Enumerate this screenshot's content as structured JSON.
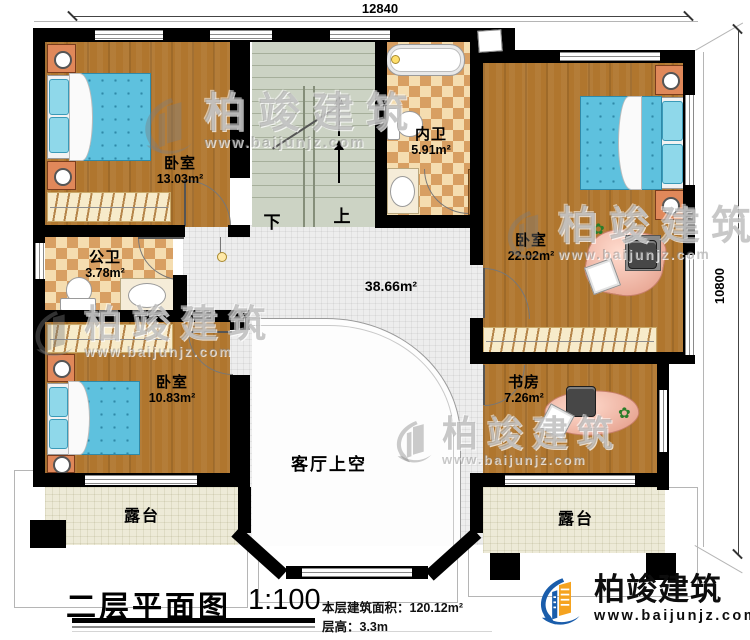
{
  "dimensions": {
    "top": "12840",
    "right": "10800"
  },
  "rooms": {
    "bedroom_top_left": {
      "name": "卧室",
      "area": "13.03m²"
    },
    "public_bath": {
      "name": "公卫",
      "area": "3.78m²"
    },
    "ensuite_bath": {
      "name": "内卫",
      "area": "5.91m²"
    },
    "bedroom_right": {
      "name": "卧室",
      "area": "22.02m²"
    },
    "bedroom_bottom_left": {
      "name": "卧室",
      "area": "10.83m²"
    },
    "study": {
      "name": "书房",
      "area": "7.26m²"
    },
    "hall": {
      "area": "38.66m²"
    },
    "living_void": {
      "name": "客厅上空"
    },
    "terrace_left": {
      "name": "露台"
    },
    "terrace_right": {
      "name": "露台"
    }
  },
  "stairs": {
    "down_label": "下",
    "up_label": "上"
  },
  "title_block": {
    "title": "二层平面图",
    "scale": "1:100",
    "floor_area": "本层建筑面积：120.12m²",
    "floor_height": "层高：3.3m"
  },
  "brand": {
    "name": "柏竣建筑",
    "website": "www.baijunjz.com"
  },
  "watermark": {
    "name": "柏竣建筑",
    "website": "www.baijunjz.com"
  },
  "icons": {
    "plant": "✿"
  },
  "colors": {
    "wall": "#000000",
    "wood_floor": "#b0762e",
    "checker_light": "#f5ddb0",
    "checker_dark": "#d89f62",
    "stair": "#ccd3c4",
    "hall_tile": "#ededed",
    "terrace": "#edead7",
    "bed": "#5ec1de",
    "brand_blue": "#1a5dab",
    "brand_orange": "#f5a31f"
  }
}
